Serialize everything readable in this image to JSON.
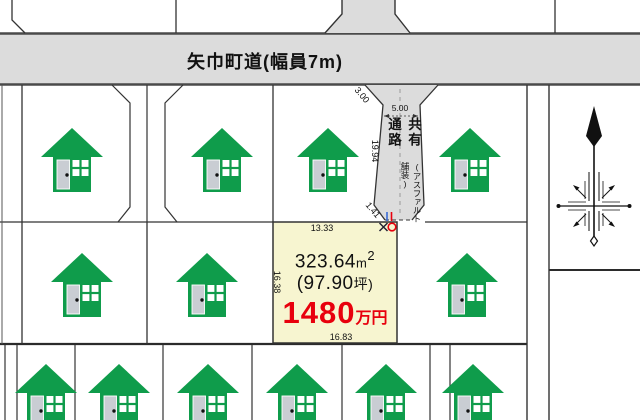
{
  "map": {
    "road_label": "矢巾町道(幅員7m)",
    "corridor": {
      "name": "共有通路",
      "surface_note": "(アスファルト舗装)"
    },
    "plot": {
      "area_value": "323.64",
      "area_unit_base": "m",
      "area_unit_exp": "2",
      "tsubo_value": "(97.90",
      "tsubo_unit": "坪)",
      "price_value": "1480",
      "price_unit": "万円"
    },
    "dimensions": {
      "top_edge": "13.33",
      "left_edge": "16.38",
      "bottom_edge": "16.83",
      "corridor_length": "19.94",
      "corridor_width": "5.00",
      "corner_cut_north": "3.00",
      "corner_cut_south": "1.41"
    },
    "colors": {
      "house_green": "#0f9c4b",
      "road_gray": "#dcdcdc",
      "plot_yellow": "#f7f5d0",
      "price_red": "#e8000d",
      "line_dark": "#333333"
    }
  }
}
